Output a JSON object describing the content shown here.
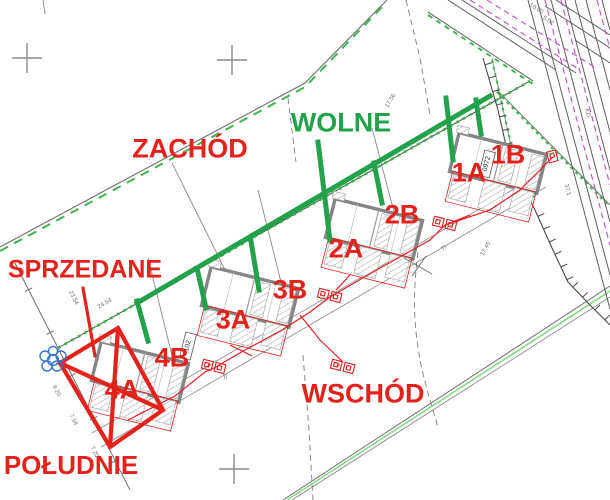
{
  "labels": {
    "zachod": "ZACHÓD",
    "wolne": "WOLNE",
    "sprzedane": "SPRZEDANE",
    "wschod": "WSCHÓD",
    "poludnie": "POŁUDNIE"
  },
  "units": [
    {
      "label": "1A"
    },
    {
      "label": "1B"
    },
    {
      "label": "2A"
    },
    {
      "label": "2B"
    },
    {
      "label": "3A"
    },
    {
      "label": "3B"
    },
    {
      "label": "4A"
    },
    {
      "label": "4B"
    }
  ],
  "annotations": [
    {
      "text": "24.54"
    },
    {
      "text": "23.54"
    },
    {
      "text": "17.56"
    },
    {
      "text": "17.45"
    },
    {
      "text": "9.20"
    },
    {
      "text": "7.04"
    },
    {
      "text": "7.20"
    },
    {
      "text": "37.1"
    },
    {
      "text": "KD"
    },
    {
      "text": "10.00"
    },
    {
      "text": "5.02"
    },
    {
      "text": "Tl"
    },
    {
      "text": "Tl"
    },
    {
      "text": "e"
    },
    {
      "text": "e"
    }
  ],
  "parcels": [
    {
      "text": "0972"
    },
    {
      "text": "102"
    }
  ],
  "colors": {
    "available_green": "#23a24b",
    "sold_red": "#e3221c",
    "boundary_green": "#3fb54e",
    "se_green": "#85dd85",
    "utility_magenta": "#c44fc9",
    "water_blue": "#3a76c8",
    "line_grey": "#707070"
  }
}
